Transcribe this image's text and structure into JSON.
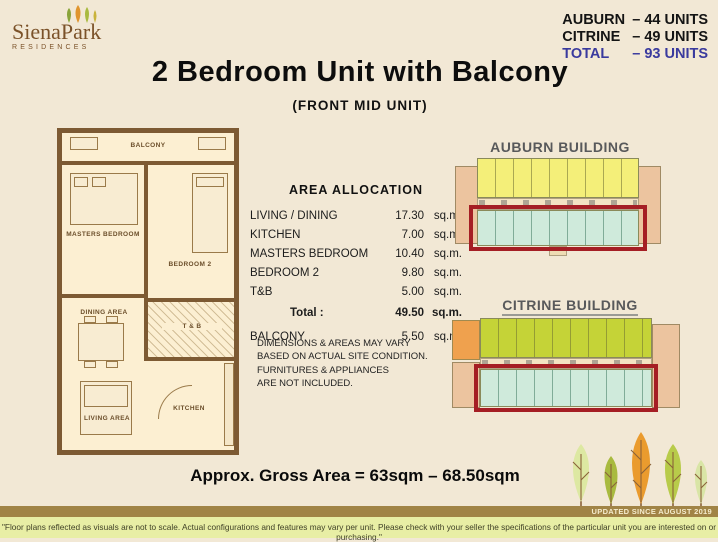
{
  "logo": {
    "name": "SienaPark",
    "sub": "RESIDENCES"
  },
  "unit_summary": {
    "auburn_label": "AUBURN",
    "auburn_value": "– 44 UNITS",
    "citrine_label": "CITRINE",
    "citrine_value": "– 49 UNITS",
    "total_label": "TOTAL",
    "total_value": "– 93 UNITS",
    "total_color": "#3a3a9e"
  },
  "title": "2 Bedroom Unit with Balcony",
  "subtitle": "(FRONT MID UNIT)",
  "floor_plan": {
    "balcony": "BALCONY",
    "masters_bedroom": "MASTERS BEDROOM",
    "bedroom2": "BEDROOM 2",
    "dining": "DINING AREA",
    "tb": "T & B",
    "living": "LIVING AREA",
    "kitchen": "KITCHEN"
  },
  "area_allocation": {
    "title": "AREA ALLOCATION",
    "rows": [
      {
        "label": "LIVING / DINING",
        "value": "17.30",
        "unit": "sq.m."
      },
      {
        "label": "KITCHEN",
        "value": "7.00",
        "unit": "sq.m."
      },
      {
        "label": "MASTERS BEDROOM",
        "value": "10.40",
        "unit": "sq.m."
      },
      {
        "label": "BEDROOM 2",
        "value": "9.80",
        "unit": "sq.m."
      },
      {
        "label": "T&B",
        "value": "5.00",
        "unit": "sq.m."
      }
    ],
    "total": {
      "label": "Total :",
      "value": "49.50",
      "unit": "sq.m."
    },
    "balcony": {
      "label": "BALCONY",
      "value": "5.50",
      "unit": "sq.m."
    },
    "disclaimer": "DIMENSIONS & AREAS MAY VARY\nBASED ON ACTUAL SITE CONDITION.\nFURNITURES & APPLIANCES\nARE NOT INCLUDED."
  },
  "buildings": {
    "auburn": "AUBURN BUILDING",
    "citrine": "CITRINE BUILDING",
    "highlight_color": "#a51e24",
    "auburn_top_row_color": "#f4ef79",
    "citrine_top_row_color": "#c5d337",
    "highlighted_row_color": "#cfeadb",
    "endcap_color": "#ecc49f"
  },
  "gross_area": "Approx. Gross Area = 63sqm – 68.50sqm",
  "footer": {
    "updated": "UPDATED SINCE AUGUST 2019",
    "disclaimer": "\"Floor plans reflected as visuals are not to scale. Actual configurations and features may vary per unit. Please check with your seller the specifications of the particular unit you are interested on or purchasing.\""
  }
}
